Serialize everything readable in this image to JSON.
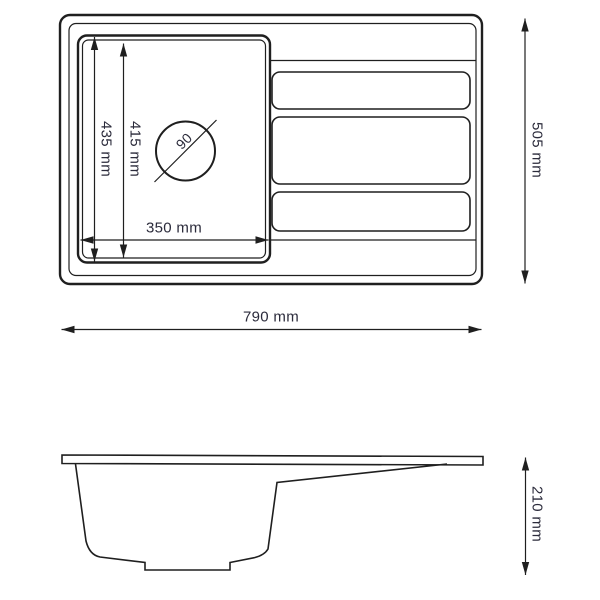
{
  "colors": {
    "background": "#ffffff",
    "line": "#1f1f1f",
    "dimension_text": "#2b2b3b"
  },
  "drawing": {
    "top_view": {
      "overall_width_label": "790 mm",
      "overall_depth_label": "505 mm",
      "bowl_width_label": "350 mm",
      "bowl_depth_outer_label": "435 mm",
      "bowl_depth_inner_label": "415 mm",
      "drain_diameter_label": "90"
    },
    "side_view": {
      "height_label": "210 mm"
    }
  }
}
